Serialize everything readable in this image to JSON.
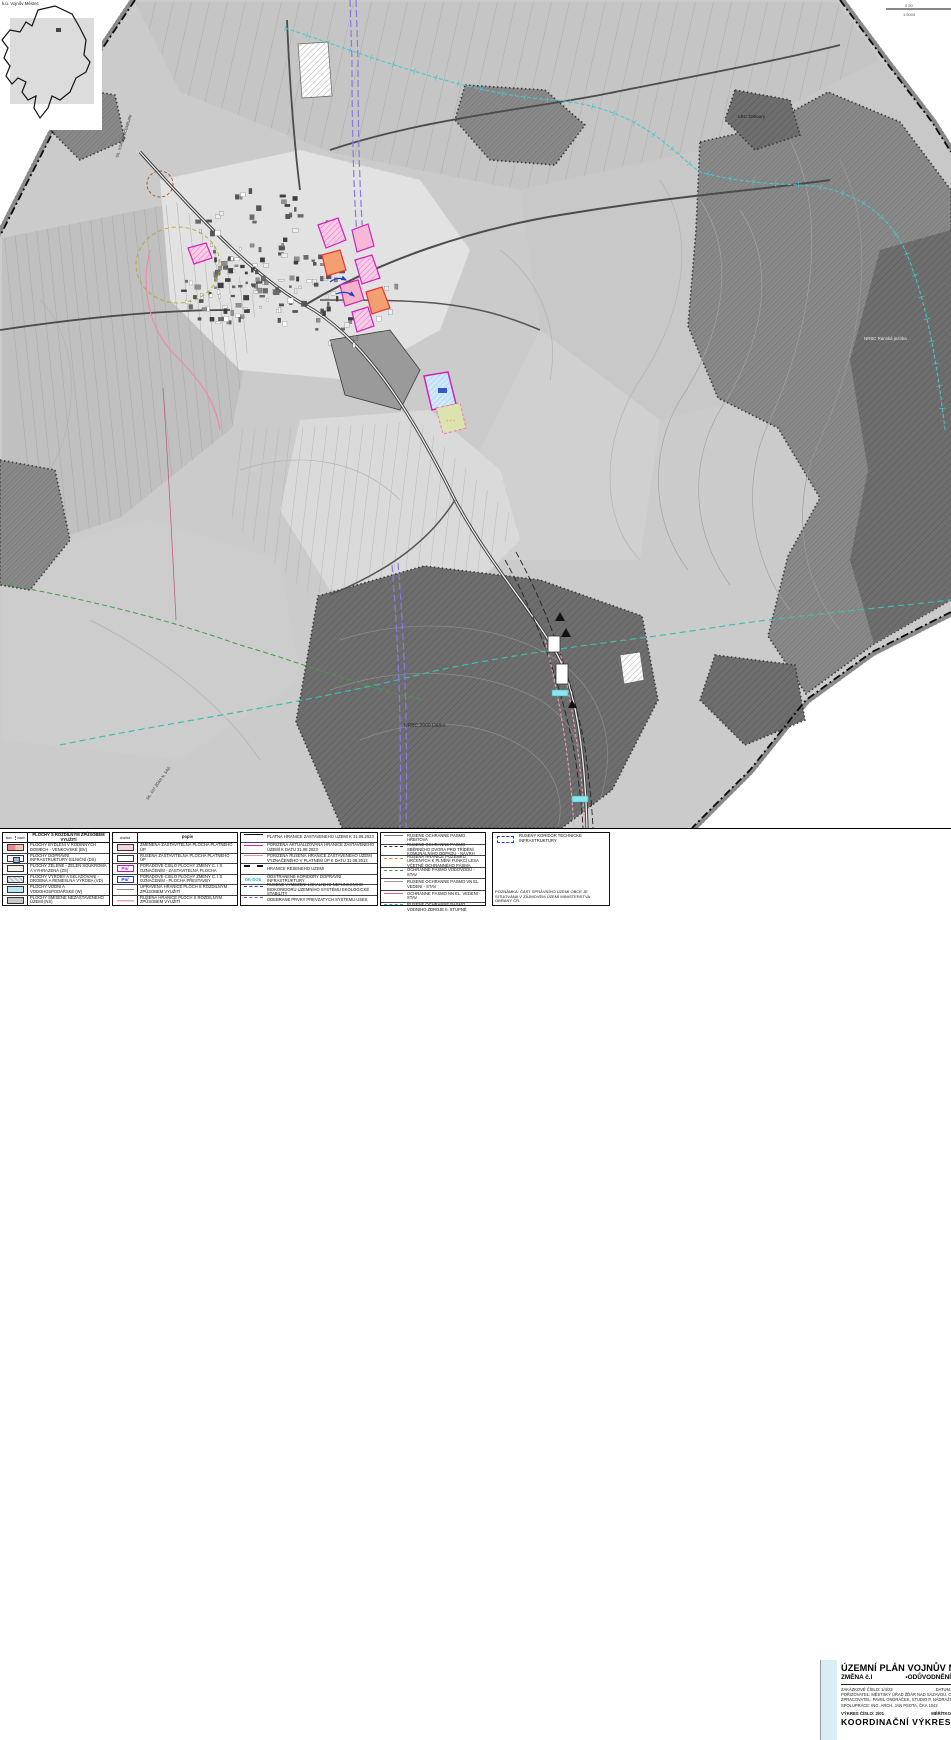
{
  "inset": {
    "caption": "k.ú. Vojnův Městec"
  },
  "map": {
    "labels": {
      "lbc": "LBC Zahoury",
      "nrbc": "NRBC 2009 Dářko",
      "ranska": "NRBC Ranská jezírka",
      "road_left": "SIL. II/343 KRUCEMBURK",
      "road_bottom": "SIL. I/37 ŽĎÁR N. SÁZ.",
      "scale_top": "0 50",
      "scale_bottom": "1:5000"
    },
    "colors": {
      "change_magenta": "#d024b8",
      "water_cyan": "#45c8cc",
      "corridor_violet": "#8a7ae0",
      "uses_teal": "#3cbfae",
      "uses_green": "#3f9d3f",
      "cancelled_pink": "#f08aa8",
      "titleblock_stripe": "#d9edf4"
    }
  },
  "legend": {
    "land_use": {
      "header": "PLOCHY S ROZDÍLNÝM ZPŮSOBEM VYUŽITÍ",
      "sub_left": "stav",
      "sub_right": "návrh",
      "items": [
        {
          "label": "PLOCHY BYDLENÍ V RODINNÝCH DOMECH - VENKOVSKÉ (BV)",
          "sw": "bv"
        },
        {
          "label": "PLOCHY DOPRAVNÍ INFRASTRUKTURY SILNIČNÍ (DS)",
          "sw": "ds"
        },
        {
          "label": "PLOCHY ZELENĚ - ZELEŇ SOUKROMÁ A VYHRAZENÁ (ZS)",
          "sw": "zs"
        },
        {
          "label": "PLOCHY VÝROBY A SKLADOVÁNÍ - DROBNÁ A ŘEMESLNÁ VÝROBA (VD)",
          "sw": "vd"
        },
        {
          "label": "PLOCHY VODNÍ A VODOHOSPODÁŘSKÉ (W)",
          "sw": "w"
        },
        {
          "label": "PLOCHY SMÍŠENÉ NEZASTAVĚNÉHO ÚZEMÍ (NS)",
          "sw": "ns"
        }
      ]
    },
    "changes": {
      "sub_left": "značka",
      "sub_right": "popis",
      "items": [
        {
          "label": "ZMĚNĚNÁ ZASTAVITELNÁ PLOCHA PLATNÉHO ÚP",
          "sw": "pink"
        },
        {
          "label": "RUŠENÁ ZASTAVITELNÁ PLOCHA PLATNÉHO ÚP",
          "sw": "white"
        },
        {
          "label": "POŘADOVÉ ČÍSLO PLOCHY ZMĚNY Č. I S OZNAČENÍM - ZASTAVITELNÁ PLOCHA",
          "sw": "pnmag",
          "sym": "Pn/"
        },
        {
          "label": "POŘADOVÉ ČÍSLO PLOCHY ZMĚNY Č. I S OZNAČENÍM - PLOCHA PŘESTAVBY",
          "sw": "pnblue",
          "sym": "Pn/"
        },
        {
          "label": "UPRAVENÁ HRANICE PLOCH S ROZDÍLNÝM ZPŮSOBEM VYUŽITÍ",
          "sw": "upline"
        },
        {
          "label": "RUŠENÁ HRANICE PLOCH S ROZDÍLNÝM ZPŮSOBEM VYUŽITÍ",
          "sw": "rusline"
        }
      ]
    },
    "boundaries": {
      "items": [
        {
          "label": "PLATNÁ HRANICE ZASTAVĚNÉHO ÚZEMÍ K 31.08.2023",
          "sw": "lnblack"
        },
        {
          "label": "POŘÍZENÁ AKTUALIZOVANÁ HRANICE ZASTAVĚNÉHO ÚZEMÍ K DATU 31.08.2023",
          "sw": "lnmag"
        },
        {
          "label": "POŘÍZENÁ RUŠENÁ HRANICE ZASTAVĚNÉHO ÚZEMÍ VYZNAČENÉHO V PLATNÉM ÚP K DATU 31.08.2013",
          "sw": "lnpink"
        },
        {
          "label": "HRANICE ŘEŠENÉHO ÚZEMÍ",
          "sw": "lnbdash"
        },
        {
          "label": "ODSTRANĚNÉ KORIDORY DOPRAVNÍ INFRASTRUKTURY",
          "sw": "lncyan",
          "sym": "DK-DO5"
        },
        {
          "label": "RUŠENÉ VYMEZENÍ LOKÁLNÍHO NEFUNKČNÍHO BIOKORIDORU ÚZEMNÍHO SYSTÉMU EKOLOGICKÉ STABILITY",
          "sw": "lnbluedash"
        },
        {
          "label": "ODEBRANÉ PRVKY PŘEVZATÝCH SYSTÉMŮ ÚSES",
          "sw": "lnuses"
        }
      ]
    },
    "protection": {
      "items": [
        {
          "label": "RUŠENÉ OCHRANNÉ PÁSMO HŘBITOVA",
          "sw": "lngray"
        },
        {
          "label": "RUŠENÉ OCHRANNÉ PÁSMO SBĚRNÉHO DVORA PRO TŘÍDĚNÍ KOMUNÁLNÍHO ODPADU - NÁVRH",
          "sw": "lnbkdash"
        },
        {
          "label": "RUŠENÁ HRANICE POZEMKŮ URČENÝCH K PLNĚNÍ FUNKCÍ LESA VČETNĚ OCHRANNÉHO PÁSMA",
          "sw": "lnorange"
        },
        {
          "label": "OCHRANNÉ PÁSMO VODOVODU - STAV",
          "sw": "lngreen"
        },
        {
          "label": "RUŠENÉ OCHRANNÉ PÁSMO VN EL. VEDENÍ - STAV",
          "sw": "lnvn"
        },
        {
          "label": "OCHRANNÉ PÁSMO NN EL. VEDENÍ - STAV",
          "sw": "lnnn"
        },
        {
          "label": "RUŠENÉ OCHRANNÉ PÁSMO VODNÍHO ZDROJE II. STUPNĚ",
          "sw": "lnteal"
        }
      ]
    },
    "corridors": {
      "items": [
        {
          "label": "RUŠENÝ KORIDOR TECHNICKÉ INFRASTRUKTURY",
          "sw": "koridor"
        }
      ],
      "note": "POZNÁMKA: ČÁST SPRÁVNÍHO ÚZEMÍ OBCE JE SITUOVÁNA V ZÁJMOVÉM ÚZEMÍ MINISTERSTVA OBRANY ČR."
    }
  },
  "titleblock": {
    "title": "ÚZEMNÍ PLÁN VOJNŮV MĚSTEC",
    "change": "ZMĚNA č.I",
    "part": "▪ODŮVODNĚNÍ",
    "order_no": "ZAKÁZKOVÉ ČÍSLO: 1/4/23",
    "date_label": "DATUM:",
    "client": "POŘIZOVATEL: MĚSTSKÝ ÚŘAD ŽĎÁR NAD SÁZAVOU, ODBOR STAVEBNÍ A ÚZEMNÍHO PLÁNOVÁNÍ",
    "author": "ZPRACOVATEL: PAVEL ONDRÁČEK, STUDIO P, NÁDRAŽNÍ 52, ŽĎÁR NAD SÁZAVOU",
    "cooperation": "SPOLUPRÁCE: ING. ARCH. JAN PSOTA, ČKA 1042",
    "drawing_no": "VÝKRES ČÍSLO: 2/01",
    "scale_label": "MĚŘÍTKO",
    "drawing_name": "KOORDINAČNÍ VÝKRES ▪"
  }
}
